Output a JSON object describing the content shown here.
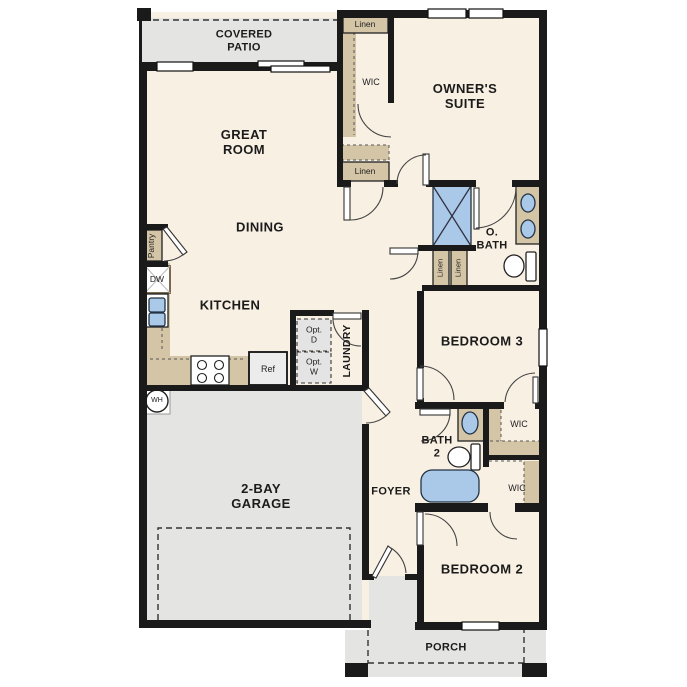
{
  "labels": {
    "covered_patio": "COVERED\nPATIO",
    "great_room": "GREAT\nROOM",
    "dining": "DINING",
    "kitchen": "KITCHEN",
    "owners_suite": "OWNER'S\nSUITE",
    "o_bath": "O.\nBATH",
    "bedroom_3": "BEDROOM 3",
    "bedroom_2": "BEDROOM 2",
    "bath_2": "BATH\n2",
    "foyer": "FOYER",
    "laundry": "LAUNDRY",
    "garage": "2-BAY\nGARAGE",
    "porch": "PORCH",
    "wic": "WIC",
    "linen": "Linen",
    "pantry": "Pantry",
    "dw": "DW",
    "ref": "Ref",
    "opt_d": "Opt.\nD",
    "opt_w": "Opt.\nW",
    "wh": "WH"
  },
  "colors": {
    "wall": "#1a1a1a",
    "floor": "#f8f0e3",
    "outdoor": "#e4e4e2",
    "cabinet": "#d5c5a7",
    "fixture_blue": "#aac9e9",
    "dashed_box": "#e4e4e4"
  }
}
